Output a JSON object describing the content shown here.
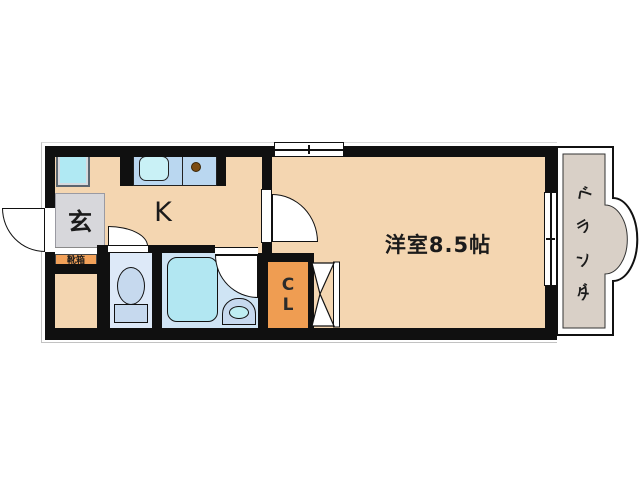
{
  "plan": {
    "rooms": {
      "genkan_label": "玄",
      "kitchen_label": "K",
      "western_room_label": "洋室8.5帖",
      "closet_line1": "C",
      "closet_line2": "L",
      "shoe_box_label": "靴箱",
      "veranda_chars": [
        "ベ",
        "ラ",
        "ン",
        "ダ"
      ]
    },
    "colors": {
      "floor_peach": "#f4d6b1",
      "wall_black": "#101010",
      "genkan_gray": "#d7d7db",
      "toilet_room_blue": "#dde9f8",
      "bath_room_blue": "#cfe4f4",
      "fixture_blue": "#c6d9ee",
      "tub_cyan": "#b2e7f2",
      "sink_cyan": "#c9f1f6",
      "counter_blue": "#bad7f0",
      "washer_pan_cyan": "#b0e9f3",
      "closet_orange": "#ef9d52",
      "shoe_box_orange": "#f2a159",
      "veranda_gray": "#d9d0c7",
      "burner_brown": "#7c4c12"
    }
  }
}
